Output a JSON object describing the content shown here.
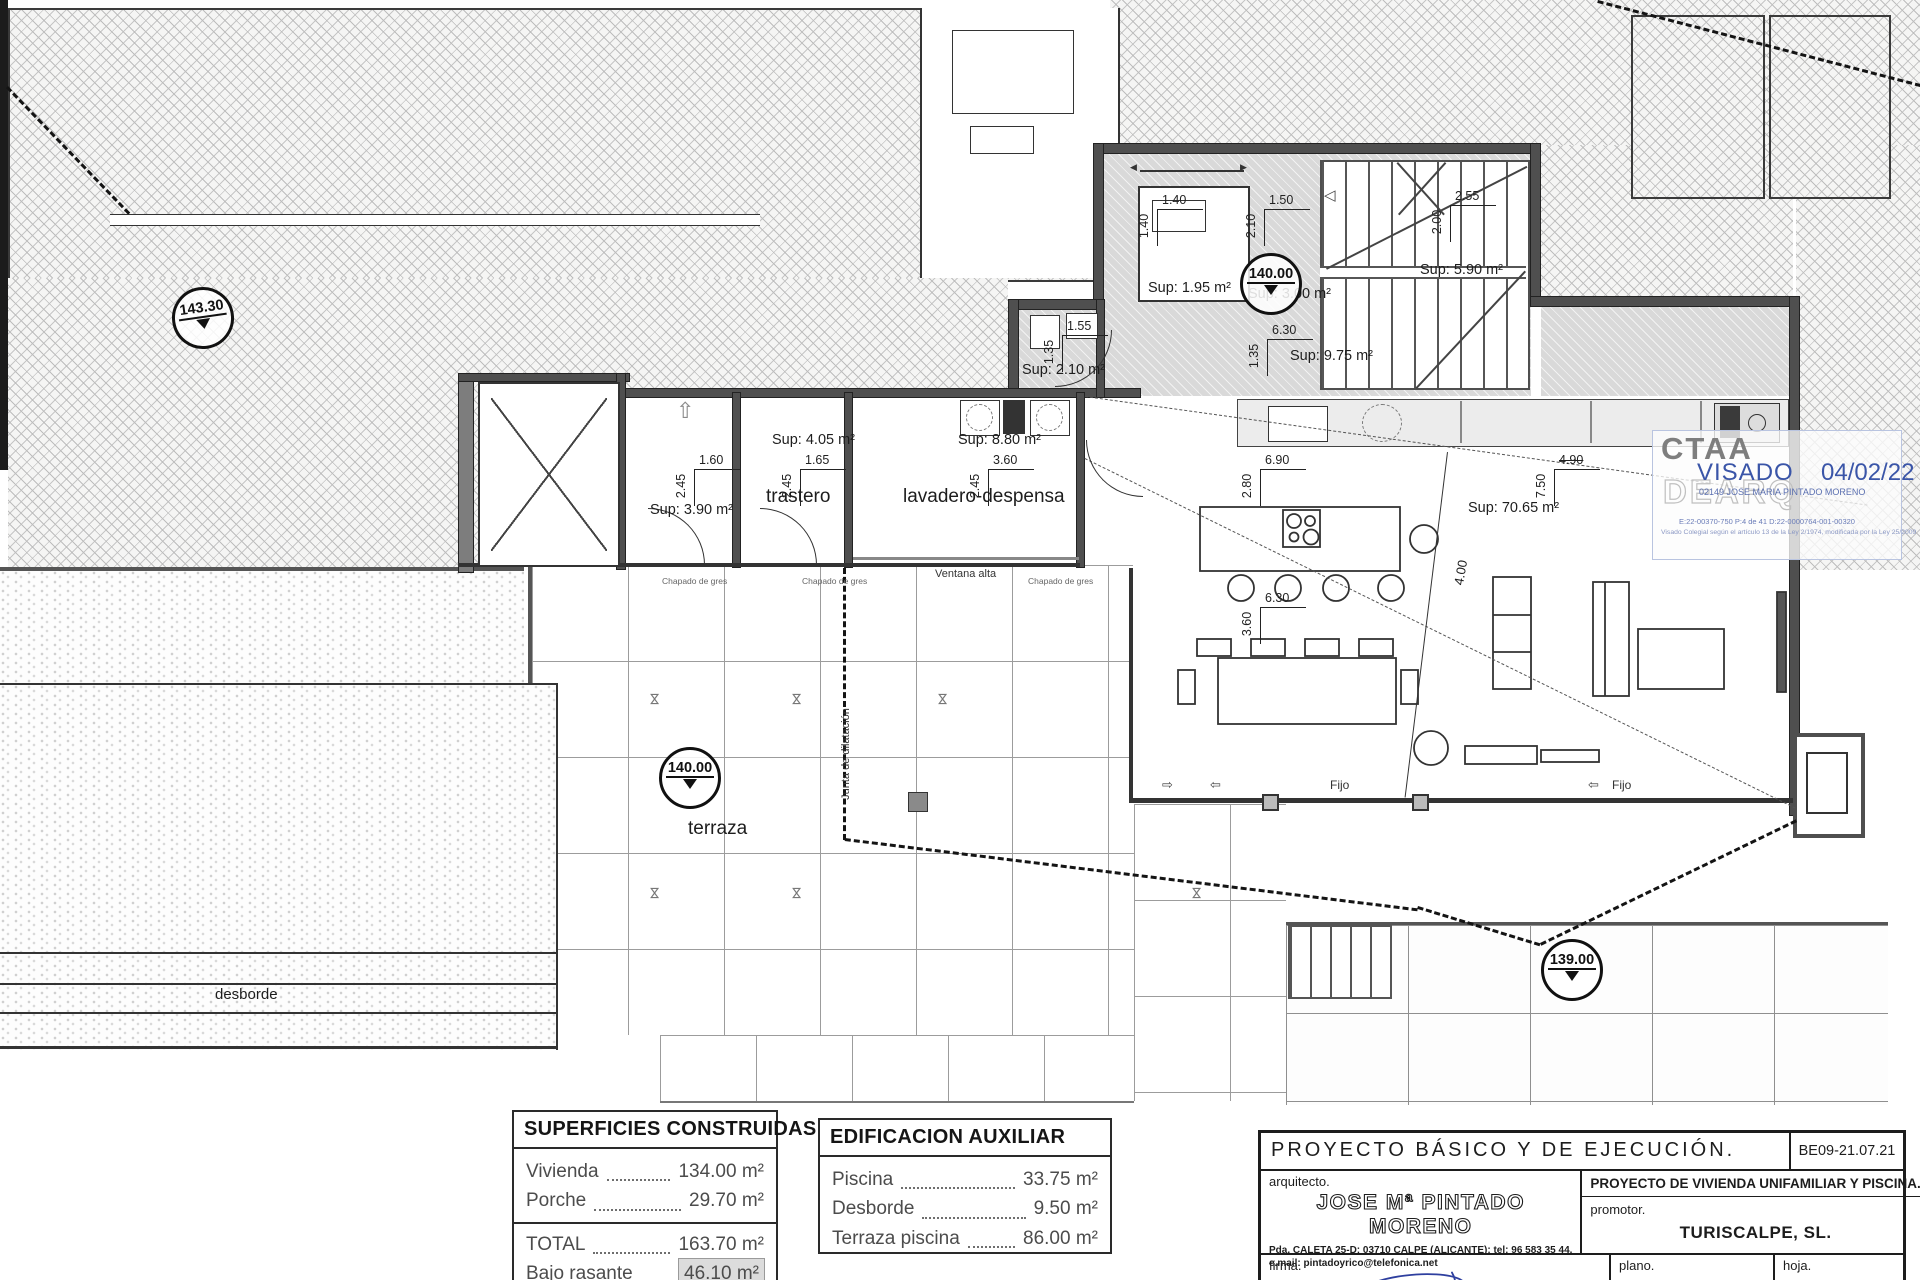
{
  "plan": {
    "elevations": {
      "site": "143.30",
      "entry": "140.00",
      "terrace": "140.00",
      "lower": "139.00"
    },
    "rooms": {
      "aseo": {
        "sup": "Sup: 1.95 m²",
        "w": "1.40",
        "h": "1.40"
      },
      "hall": {
        "sup": "Sup: 3.00 m²",
        "w": "1.50",
        "h": "2.10"
      },
      "escalera": {
        "sup": "Sup: 5.90 m²",
        "w": "2.55",
        "h": "2.00"
      },
      "pasillo": {
        "sup": "Sup: 9.75 m²",
        "w": "6.30",
        "h": "1.35"
      },
      "lavanderia": {
        "sup": "Sup: 2.10 m²",
        "w": "1.55",
        "h": "1.35"
      },
      "bano": {
        "sup": "Sup: 3.90 m²",
        "w": "1.60",
        "h": "2.45"
      },
      "trastero": {
        "label": "trastero",
        "sup": "Sup: 4.05 m²",
        "w": "1.65",
        "h": "2.45"
      },
      "lavadero": {
        "label": "lavadero-despensa",
        "sup": "Sup: 8.80 m²",
        "w": "3.60",
        "h": "2.45"
      },
      "salon": {
        "sup": "Sup: 70.65 m²",
        "w1": "6.90",
        "h1": "2.80",
        "w2": "6.30",
        "h2": "3.60",
        "w3": "4.90",
        "h3": "7.50",
        "diag": "4.00"
      }
    },
    "labels": {
      "terraza": "terraza",
      "desborde": "desborde",
      "junta": "Junta de dilatación",
      "ventana_alta": "Ventana alta",
      "fijo": "Fijo",
      "chapado": "Chapado de gres"
    }
  },
  "stamp": {
    "org": "CTAA",
    "watermark": "DEARQ",
    "visado": "VISADO",
    "date": "04/02/22",
    "colegiado": "02149 JOSE MARIA PINTADO MORENO",
    "refs": "E:22-00370-750      P:4 de 41      D:22-0000764-001-00320",
    "legal": "Visado Colegial según el artículo 13 de la Ley 2/1974, modificada por la Ley 25/2009",
    "accent": "#3a55a8"
  },
  "tables": {
    "superficies": {
      "title": "SUPERFICIES CONSTRUIDAS",
      "rows": [
        {
          "name": "Vivienda",
          "value": "134.00 m²"
        },
        {
          "name": "Porche",
          "value": "29.70 m²"
        }
      ],
      "total": [
        {
          "name": "TOTAL",
          "value": "163.70 m²"
        },
        {
          "name": "Bajo rasante",
          "value": "46.10 m²"
        }
      ]
    },
    "auxiliar": {
      "title": "EDIFICACION AUXILIAR",
      "rows": [
        {
          "name": "Piscina",
          "value": "33.75 m²"
        },
        {
          "name": "Desborde",
          "value": "9.50 m²"
        },
        {
          "name": "Terraza piscina",
          "value": "86.00 m²"
        }
      ]
    }
  },
  "titleblock": {
    "project_header": "PROYECTO  BÁSICO  Y  DE  EJECUCIÓN.",
    "code": "BE09-21.07.21",
    "arquitecto_label": "arquitecto.",
    "arquitecto_name": "JOSE Mª PINTADO MORENO",
    "address": "Pda. CALETA 25-D; 03710 CALPE (ALICANTE); tel: 96 583 35 44.",
    "email": "e.mail: pintadoyrico@telefonica.net",
    "project_desc": "PROYECTO  DE  VIVIENDA  UNIFAMILIAR  Y  PISCINA.",
    "promotor_label": "promotor.",
    "promotor_name": "TURISCALPE, SL.",
    "escala_label": "escala",
    "escala_value": "1:50",
    "firma_label": "firma.",
    "plano_label": "plano.",
    "plano_name": "DISTRIBUCION  PLANTA  BAJA",
    "hoja_label": "hoja.",
    "hoja_value": "4"
  }
}
